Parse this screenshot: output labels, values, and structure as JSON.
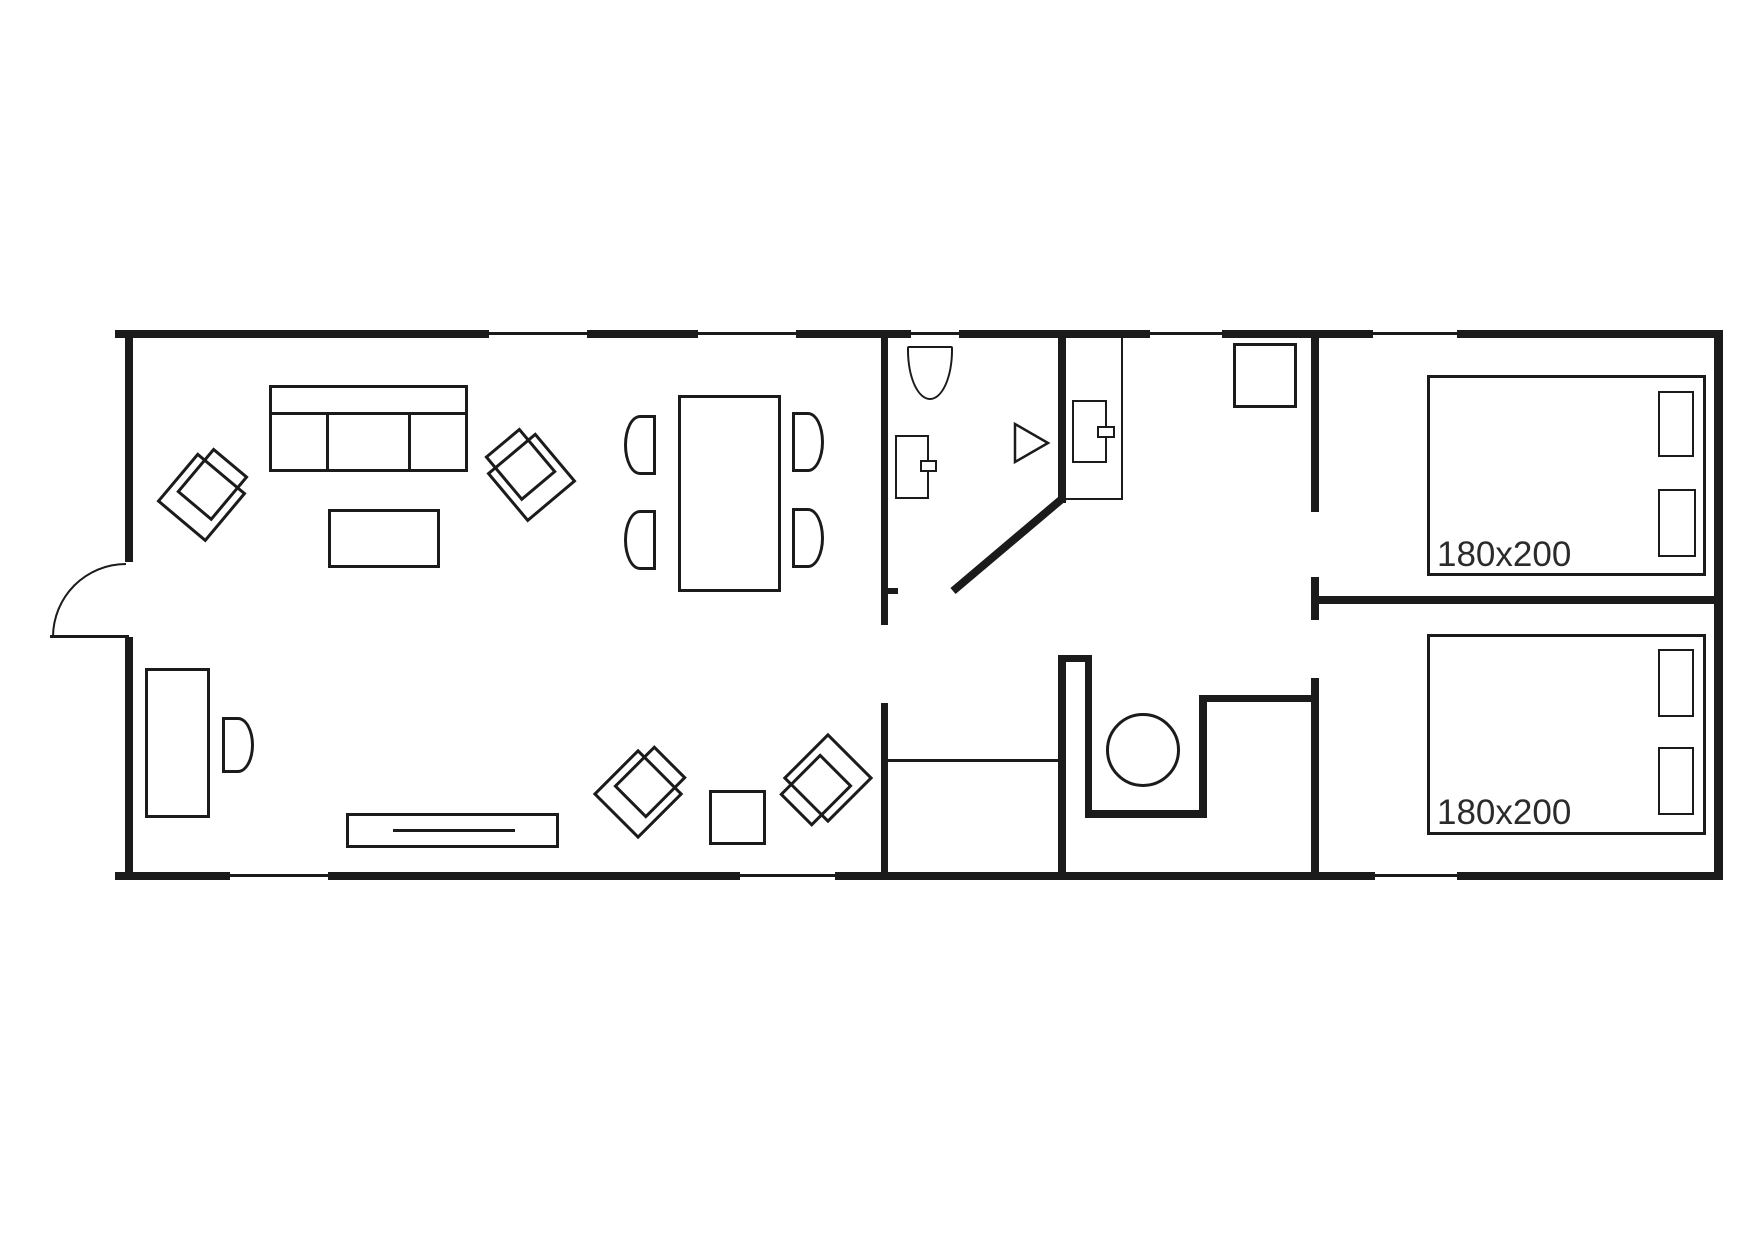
{
  "plan": {
    "bedroom1": {
      "size_label": "180x200"
    },
    "bedroom2": {
      "size_label": "180x200"
    },
    "colors": {
      "line": "#1b1b1b",
      "background": "#ffffff",
      "text": "#2b2b2b"
    }
  }
}
